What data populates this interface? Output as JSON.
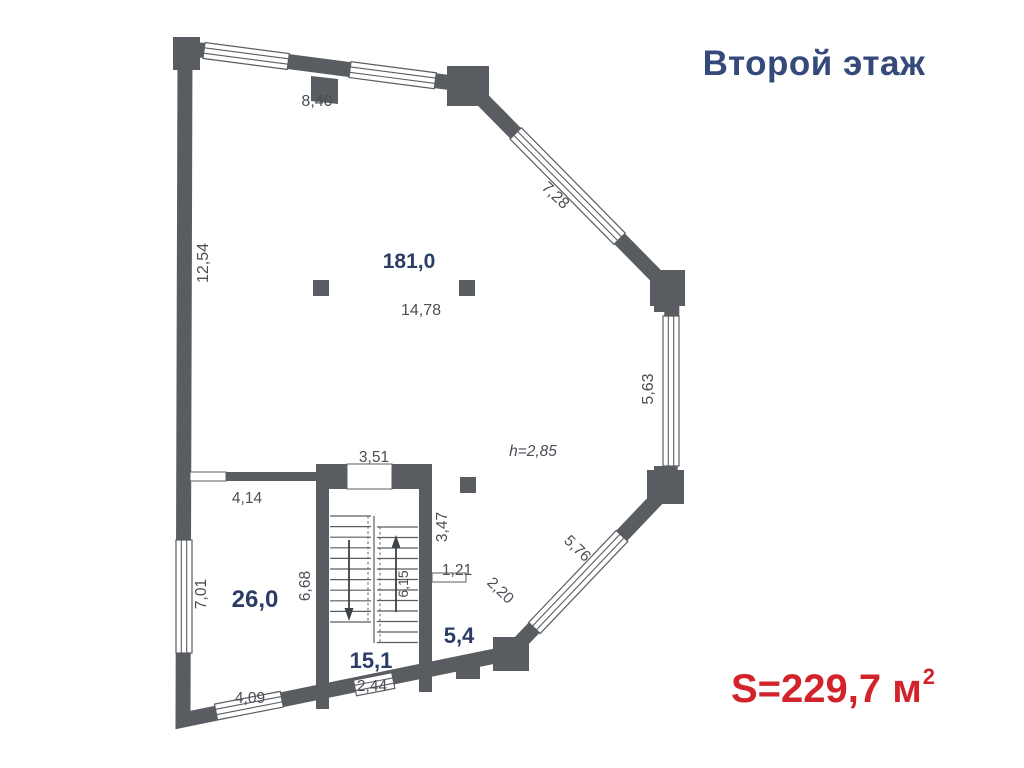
{
  "header": {
    "title": "Второй этаж",
    "color": "#35497B"
  },
  "footer": {
    "area_text": "S=229,7 м",
    "area_sup": "2",
    "color": "#D2232A"
  },
  "plan": {
    "wall_color": "#595D61",
    "dim_text_color": "#4A4E55",
    "area_text_color": "#2B3D66",
    "areas": {
      "hall": "181,0",
      "room_left": "26,0",
      "staircase": "15,1",
      "entry": "5,4"
    },
    "dims": {
      "top_wall": "8,40",
      "upper_diagonal": "7,28",
      "left_wall_upper": "12,54",
      "hall_width": "14,78",
      "right_wall": "5,63",
      "ceiling_height": "h=2,85",
      "stair_top": "3,51",
      "partition_door": "4,14",
      "stair_right": "3,47",
      "small_door": "1,21",
      "small_room_diagonal": "2,20",
      "lower_diagonal": "5,76",
      "left_wall_lower": "7,01",
      "stair_left": "6,68",
      "stair_flight": "6,15",
      "stair_bottom_window": "2,44",
      "bottom_wall": "4,09"
    }
  }
}
